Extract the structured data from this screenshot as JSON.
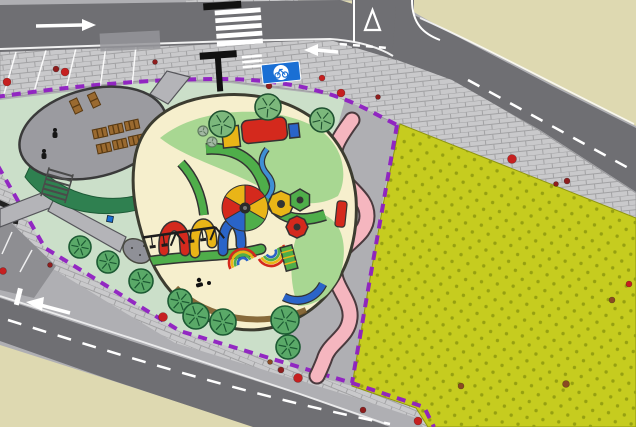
{
  "site": {
    "name": "playground-landscape-site-plan",
    "canvas_width": 636,
    "canvas_height": 427
  },
  "palette": {
    "road": "#6f6f73",
    "pavement": "#afafb3",
    "sidewalk": "#c9c9cb",
    "sidewalk_line": "#a2a2a4",
    "lawn": "#cbdfc9",
    "hedge": "#2f8050",
    "field": "#c6cc1f",
    "field_dot": "#96a011",
    "beige": "#ded9b1",
    "boundary": "#8f1fc2",
    "pink": "#f5b6bf",
    "pink_edge": "#4a3a3e",
    "outline": "#3c3c30",
    "cream": "#f6efcd",
    "grass": "#a8d792",
    "red": "#d4291d",
    "yellow": "#e9b517",
    "blue": "#2a64c8",
    "green": "#4fae4a",
    "water": "#3f8fd4",
    "platform": "#9b9ba0",
    "platform_edge": "#3a3a3a",
    "tree": "#7cb87c",
    "tree_edge": "#1f5130",
    "bush": "#5aa968",
    "bush_edge": "#1c5a33",
    "bollard_red": "#c62020",
    "bollard_dark": "#8f1d1d",
    "bollard_brown": "#8a4a22",
    "sign": "#1a6fd4",
    "bench": "#9a6a30",
    "bench_edge": "#5a3a12",
    "walk": "#b4b4b8",
    "driveway": "#8e8e92"
  },
  "elements": {
    "areas": [
      {
        "name": "children-playground",
        "fill": "cream"
      },
      {
        "name": "lawn",
        "fill": "lawn"
      },
      {
        "name": "sports-field",
        "fill": "field"
      },
      {
        "name": "oval-plaza",
        "fill": "platform"
      },
      {
        "name": "winding-footpath",
        "fill": "pink"
      },
      {
        "name": "site-boundary",
        "stroke": "boundary"
      },
      {
        "name": "roads",
        "fill": "road"
      },
      {
        "name": "sidewalks",
        "fill": "sidewalk"
      },
      {
        "name": "city-blocks",
        "fill": "beige"
      }
    ],
    "trees": [
      {
        "x": 222,
        "y": 124,
        "r": 13
      },
      {
        "x": 268,
        "y": 107,
        "r": 13
      },
      {
        "x": 322,
        "y": 120,
        "r": 12
      }
    ],
    "small_trees": [
      {
        "x": 203,
        "y": 131,
        "r": 5
      },
      {
        "x": 212,
        "y": 142,
        "r": 5
      }
    ],
    "bushes": [
      {
        "x": 80,
        "y": 247,
        "r": 11
      },
      {
        "x": 108,
        "y": 262,
        "r": 11
      },
      {
        "x": 141,
        "y": 281,
        "r": 12
      },
      {
        "x": 180,
        "y": 301,
        "r": 12
      },
      {
        "x": 196,
        "y": 316,
        "r": 13
      },
      {
        "x": 223,
        "y": 322,
        "r": 13
      },
      {
        "x": 285,
        "y": 320,
        "r": 14
      },
      {
        "x": 288,
        "y": 347,
        "r": 12
      }
    ],
    "bollards": [
      {
        "x": 7,
        "y": 82,
        "r": 4,
        "c": "red"
      },
      {
        "x": 56,
        "y": 69,
        "r": 3,
        "c": "dark"
      },
      {
        "x": 65,
        "y": 72,
        "r": 4,
        "c": "red"
      },
      {
        "x": 155,
        "y": 62,
        "r": 2.5,
        "c": "dark"
      },
      {
        "x": 269,
        "y": 86,
        "r": 3,
        "c": "dark"
      },
      {
        "x": 322,
        "y": 78,
        "r": 3,
        "c": "red"
      },
      {
        "x": 341,
        "y": 93,
        "r": 4,
        "c": "red"
      },
      {
        "x": 378,
        "y": 97,
        "r": 2.5,
        "c": "dark"
      },
      {
        "x": 512,
        "y": 159,
        "r": 4.5,
        "c": "red"
      },
      {
        "x": 556,
        "y": 184,
        "r": 2.5,
        "c": "dark"
      },
      {
        "x": 567,
        "y": 181,
        "r": 3,
        "c": "dark"
      },
      {
        "x": 3,
        "y": 271,
        "r": 3.5,
        "c": "red"
      },
      {
        "x": 50,
        "y": 265,
        "r": 2.5,
        "c": "dark"
      },
      {
        "x": 163,
        "y": 317,
        "r": 4.5,
        "c": "red"
      },
      {
        "x": 270,
        "y": 362,
        "r": 2.5,
        "c": "brown"
      },
      {
        "x": 281,
        "y": 370,
        "r": 3,
        "c": "dark"
      },
      {
        "x": 298,
        "y": 378,
        "r": 4.5,
        "c": "red"
      },
      {
        "x": 363,
        "y": 410,
        "r": 3,
        "c": "dark"
      },
      {
        "x": 418,
        "y": 421,
        "r": 4,
        "c": "red"
      },
      {
        "x": 461,
        "y": 386,
        "r": 3,
        "c": "brown"
      },
      {
        "x": 566,
        "y": 384,
        "r": 3.5,
        "c": "brown"
      },
      {
        "x": 612,
        "y": 300,
        "r": 3,
        "c": "brown"
      },
      {
        "x": 629,
        "y": 284,
        "r": 3,
        "c": "red"
      }
    ],
    "bench_singles": [
      {
        "x": 76,
        "y": 106,
        "rot": -25
      },
      {
        "x": 94,
        "y": 100,
        "rot": -25
      }
    ],
    "bench_tables": [
      {
        "x": 100,
        "y": 133,
        "rot": -12
      },
      {
        "x": 116,
        "y": 129,
        "rot": -12
      },
      {
        "x": 132,
        "y": 125,
        "rot": -12
      },
      {
        "x": 104,
        "y": 148,
        "rot": -12
      },
      {
        "x": 120,
        "y": 144,
        "rot": -12
      },
      {
        "x": 136,
        "y": 140,
        "rot": -12
      }
    ],
    "figures": [
      {
        "x": 55,
        "y": 133
      },
      {
        "x": 44,
        "y": 154
      },
      {
        "x": 199,
        "y": 281
      },
      {
        "x": 209,
        "y": 284
      }
    ],
    "crosswalk": {
      "stripe_count": 5
    },
    "carousel": {
      "cx": 245,
      "cy": 208,
      "r": 23,
      "sector_colors": [
        "red",
        "yellow",
        "green",
        "blue",
        "red",
        "yellow"
      ]
    }
  }
}
